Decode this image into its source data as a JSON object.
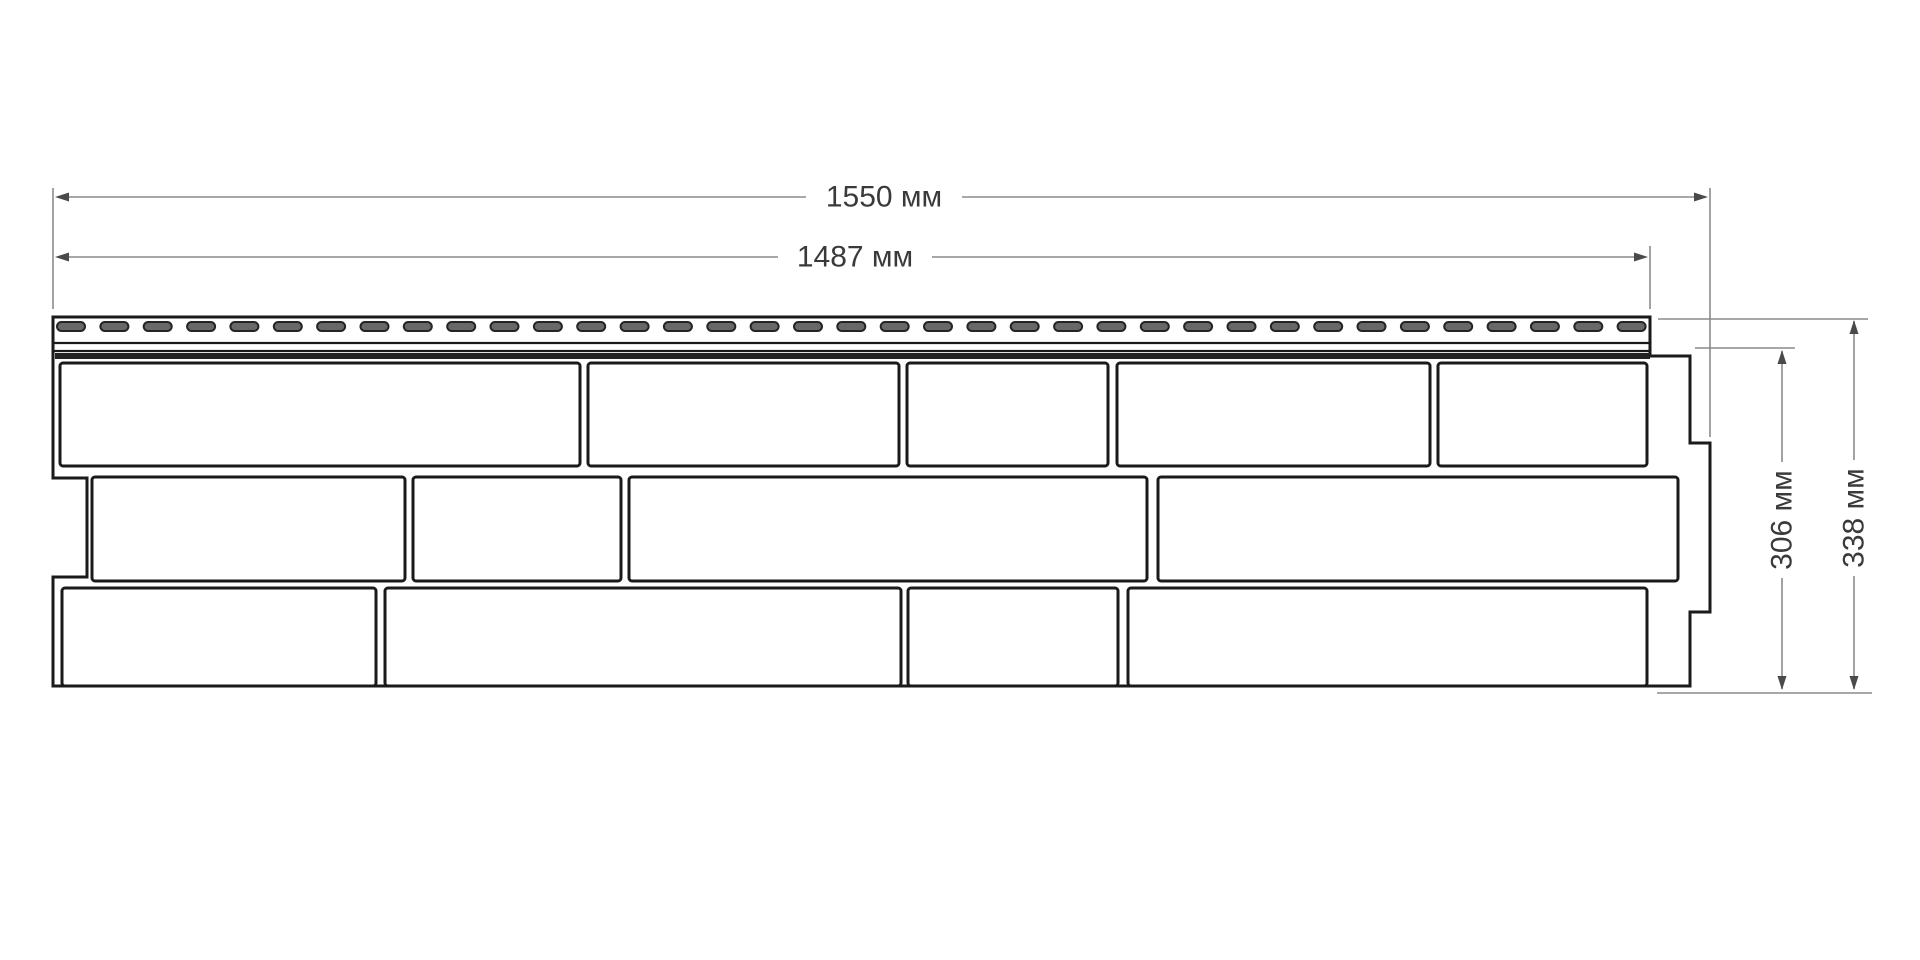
{
  "diagram": {
    "type": "technical-drawing",
    "dimensions": {
      "total_width_label": "1550 мм",
      "useful_width_label": "1487 мм",
      "useful_height_label": "306 мм",
      "total_height_label": "338 мм"
    },
    "colors": {
      "outline": "#1a1a1a",
      "dimension_line": "#8a8a8a",
      "label_text": "#3a3a3a",
      "slot_fill": "#686868"
    }
  }
}
